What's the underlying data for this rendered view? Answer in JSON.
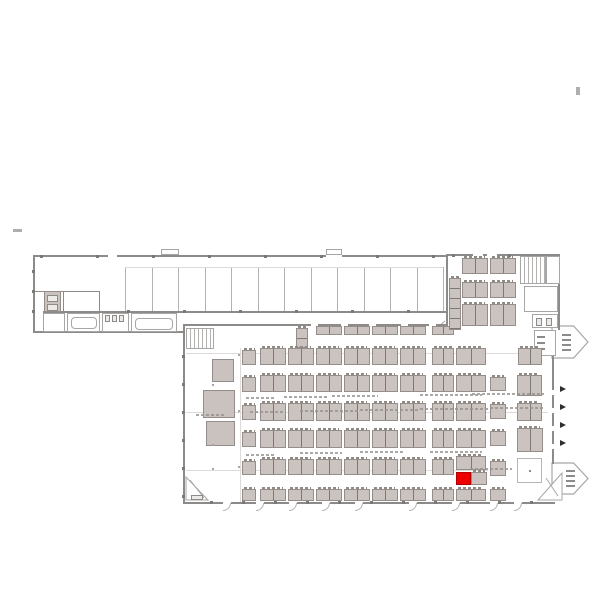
{
  "canvas": {
    "width": 600,
    "height": 600,
    "background": "#ffffff"
  },
  "colors": {
    "wall": "#8d8b89",
    "wall_light": "#b4b2b0",
    "faint": "#dddbd9",
    "booth_fill": "#cac3bf",
    "booth_border": "#948d89",
    "divider": "#7e7874",
    "highlight_red": "#ee0000",
    "arrow_dark": "#2e2e2e",
    "outline": "#a8a6a4"
  },
  "selected_booth": {
    "x": 456,
    "y": 472,
    "w": 15,
    "h": 13,
    "color": "#ee0000"
  },
  "walls": [
    [
      33,
      255,
      415,
      2
    ],
    [
      33,
      255,
      2,
      78
    ],
    [
      33,
      331,
      152,
      2
    ],
    [
      43,
      311,
      405,
      2
    ],
    [
      183,
      324,
      265,
      2
    ],
    [
      183,
      324,
      2,
      180
    ],
    [
      183,
      502,
      372,
      2
    ],
    [
      446,
      254,
      114,
      2
    ],
    [
      446,
      254,
      2,
      72
    ],
    [
      558,
      254,
      2,
      76
    ],
    [
      552,
      356,
      2,
      108
    ],
    [
      99,
      291,
      1,
      41
    ],
    [
      33,
      291,
      67,
      1
    ],
    [
      63,
      292,
      1,
      40
    ]
  ],
  "wall_gaps": [
    [
      108,
      255,
      9,
      2
    ],
    [
      326,
      255,
      16,
      2
    ],
    [
      473,
      254,
      10,
      2
    ],
    [
      487,
      254,
      10,
      2
    ],
    [
      311,
      324,
      7,
      2
    ],
    [
      341,
      324,
      7,
      2
    ],
    [
      369,
      324,
      7,
      2
    ],
    [
      401,
      324,
      7,
      2
    ],
    [
      429,
      324,
      7,
      2
    ],
    [
      552,
      390,
      2,
      5
    ],
    [
      552,
      408,
      2,
      5
    ],
    [
      552,
      426,
      2,
      5
    ],
    [
      552,
      444,
      2,
      5
    ],
    [
      223,
      502,
      8,
      2
    ],
    [
      256,
      502,
      8,
      2
    ],
    [
      289,
      502,
      8,
      2
    ],
    [
      322,
      502,
      8,
      2
    ],
    [
      355,
      502,
      8,
      2
    ],
    [
      409,
      502,
      8,
      2
    ],
    [
      452,
      502,
      8,
      2
    ],
    [
      490,
      502,
      8,
      2
    ],
    [
      514,
      502,
      8,
      2
    ]
  ],
  "partitions": {
    "x0": 125,
    "step": 26.5,
    "count": 13,
    "y": 267,
    "h": 44
  },
  "faint_lines": [
    [
      125,
      267,
      318,
      1
    ],
    [
      186,
      353,
      362,
      1
    ],
    [
      186,
      412,
      362,
      1
    ],
    [
      186,
      470,
      302,
      1
    ],
    [
      240,
      348,
      1,
      154
    ],
    [
      43,
      322,
      22,
      1
    ]
  ],
  "rooms": [
    [
      43,
      313,
      22,
      19
    ],
    [
      67,
      313,
      33,
      19
    ],
    [
      102,
      313,
      27,
      19
    ],
    [
      131,
      313,
      46,
      19
    ],
    [
      546,
      256,
      14,
      28
    ],
    [
      524,
      286,
      34,
      26
    ],
    [
      532,
      314,
      26,
      14
    ],
    [
      534,
      330,
      22,
      26
    ],
    [
      161,
      249,
      18,
      6
    ],
    [
      326,
      249,
      16,
      6
    ]
  ],
  "tables": [
    [
      71,
      317,
      26,
      12
    ],
    [
      135,
      318,
      38,
      12
    ]
  ],
  "elevator": {
    "x": 44,
    "y": 291,
    "w": 17,
    "h": 21
  },
  "fixtures": [
    [
      47,
      295,
      11,
      7
    ],
    [
      47,
      304,
      11,
      7
    ],
    [
      105,
      315,
      5,
      7
    ],
    [
      112,
      315,
      5,
      7
    ],
    [
      119,
      315,
      5,
      7
    ],
    [
      537,
      336,
      8,
      2
    ],
    [
      537,
      342,
      8,
      2
    ],
    [
      537,
      348,
      8,
      2
    ],
    [
      562,
      334,
      9,
      2
    ],
    [
      562,
      339,
      9,
      2
    ],
    [
      562,
      344,
      9,
      2
    ],
    [
      562,
      349,
      9,
      2
    ],
    [
      566,
      470,
      9,
      2
    ],
    [
      566,
      475,
      9,
      2
    ],
    [
      566,
      480,
      9,
      2
    ],
    [
      566,
      485,
      9,
      2
    ],
    [
      536,
      318,
      6,
      8
    ],
    [
      546,
      318,
      6,
      8
    ],
    [
      191,
      495,
      12,
      5
    ]
  ],
  "blocks": [
    [
      212,
      359,
      22,
      23
    ],
    [
      203,
      390,
      32,
      28
    ],
    [
      206,
      421,
      29,
      25
    ]
  ],
  "stair_rects": [
    [
      186,
      328,
      28,
      21
    ],
    [
      520,
      256,
      26,
      28
    ]
  ],
  "white_square": {
    "x": 517,
    "y": 458,
    "w": 25,
    "h": 25
  },
  "clusters": [
    [
      316,
      326,
      26,
      9,
      "h"
    ],
    [
      344,
      326,
      26,
      9,
      "h"
    ],
    [
      372,
      326,
      26,
      9,
      "h"
    ],
    [
      400,
      326,
      26,
      9,
      "h"
    ],
    [
      432,
      326,
      22,
      9,
      "h"
    ],
    [
      296,
      328,
      12,
      20,
      "v"
    ],
    [
      242,
      350,
      14,
      15,
      "s"
    ],
    [
      260,
      348,
      26,
      17,
      "h"
    ],
    [
      288,
      348,
      26,
      17,
      "h"
    ],
    [
      316,
      348,
      26,
      17,
      "h"
    ],
    [
      344,
      348,
      26,
      17,
      "h"
    ],
    [
      372,
      348,
      26,
      17,
      "h"
    ],
    [
      400,
      348,
      26,
      17,
      "h"
    ],
    [
      432,
      348,
      22,
      17,
      "h"
    ],
    [
      456,
      348,
      30,
      17,
      "h"
    ],
    [
      518,
      348,
      24,
      17,
      "h"
    ],
    [
      242,
      377,
      14,
      15,
      "s"
    ],
    [
      260,
      375,
      26,
      17,
      "h"
    ],
    [
      288,
      375,
      26,
      17,
      "h"
    ],
    [
      316,
      375,
      26,
      17,
      "h"
    ],
    [
      344,
      375,
      26,
      17,
      "h"
    ],
    [
      372,
      375,
      26,
      17,
      "h"
    ],
    [
      400,
      375,
      26,
      17,
      "h"
    ],
    [
      432,
      375,
      22,
      17,
      "h"
    ],
    [
      456,
      375,
      30,
      17,
      "h"
    ],
    [
      490,
      377,
      16,
      14,
      "s"
    ],
    [
      517,
      375,
      25,
      21,
      "h"
    ],
    [
      242,
      405,
      14,
      15,
      "s"
    ],
    [
      260,
      403,
      26,
      18,
      "h"
    ],
    [
      288,
      403,
      26,
      18,
      "h"
    ],
    [
      316,
      403,
      26,
      18,
      "h"
    ],
    [
      344,
      403,
      26,
      18,
      "h"
    ],
    [
      372,
      403,
      26,
      18,
      "h"
    ],
    [
      400,
      403,
      26,
      18,
      "h"
    ],
    [
      432,
      403,
      22,
      18,
      "h"
    ],
    [
      456,
      403,
      30,
      18,
      "h"
    ],
    [
      490,
      404,
      16,
      15,
      "s"
    ],
    [
      517,
      403,
      25,
      18,
      "h"
    ],
    [
      242,
      432,
      14,
      15,
      "s"
    ],
    [
      260,
      430,
      26,
      18,
      "h"
    ],
    [
      288,
      430,
      26,
      18,
      "h"
    ],
    [
      316,
      430,
      26,
      18,
      "h"
    ],
    [
      344,
      430,
      26,
      18,
      "h"
    ],
    [
      372,
      430,
      26,
      18,
      "h"
    ],
    [
      400,
      430,
      26,
      18,
      "h"
    ],
    [
      432,
      430,
      22,
      18,
      "h"
    ],
    [
      456,
      430,
      30,
      18,
      "h"
    ],
    [
      490,
      431,
      16,
      15,
      "s"
    ],
    [
      517,
      428,
      26,
      24,
      "h"
    ],
    [
      242,
      461,
      14,
      14,
      "s"
    ],
    [
      260,
      459,
      26,
      16,
      "h"
    ],
    [
      288,
      459,
      26,
      16,
      "h"
    ],
    [
      316,
      459,
      26,
      16,
      "h"
    ],
    [
      344,
      459,
      26,
      16,
      "h"
    ],
    [
      372,
      459,
      26,
      16,
      "h"
    ],
    [
      400,
      459,
      26,
      16,
      "h"
    ],
    [
      432,
      459,
      22,
      16,
      "h"
    ],
    [
      456,
      456,
      30,
      14,
      "h"
    ],
    [
      490,
      461,
      16,
      15,
      "s"
    ],
    [
      471,
      472,
      16,
      13,
      "s"
    ],
    [
      242,
      489,
      14,
      12,
      "s"
    ],
    [
      260,
      489,
      26,
      12,
      "h"
    ],
    [
      288,
      489,
      26,
      12,
      "h"
    ],
    [
      316,
      489,
      26,
      12,
      "h"
    ],
    [
      344,
      489,
      26,
      12,
      "h"
    ],
    [
      372,
      489,
      26,
      12,
      "h"
    ],
    [
      400,
      489,
      26,
      12,
      "h"
    ],
    [
      432,
      489,
      22,
      12,
      "h"
    ],
    [
      456,
      489,
      30,
      12,
      "h"
    ],
    [
      490,
      489,
      16,
      12,
      "s"
    ],
    [
      462,
      258,
      26,
      16,
      "h"
    ],
    [
      490,
      258,
      26,
      16,
      "h"
    ],
    [
      462,
      282,
      26,
      16,
      "h"
    ],
    [
      490,
      282,
      26,
      16,
      "h"
    ],
    [
      462,
      304,
      26,
      22,
      "h"
    ],
    [
      490,
      304,
      26,
      22,
      "h"
    ],
    [
      449,
      278,
      12,
      52,
      "v"
    ]
  ],
  "exit_pentagons": [
    {
      "x": 552,
      "y": 326,
      "w": 36,
      "h": 32
    },
    {
      "x": 552,
      "y": 463,
      "w": 36,
      "h": 31
    }
  ],
  "triangles": [
    {
      "points": "186,477 186,500 208,500"
    },
    {
      "points": "562,473 562,500 538,500"
    }
  ],
  "diagonals": [
    [
      158,
      331,
      172,
      319
    ],
    [
      433,
      331,
      445,
      321
    ],
    [
      190,
      480,
      204,
      498
    ],
    [
      546,
      478,
      558,
      496
    ]
  ],
  "door_arrows": [
    [
      560,
      386
    ],
    [
      560,
      404
    ],
    [
      560,
      422
    ],
    [
      560,
      440
    ]
  ],
  "door_arcs": [
    223,
    256,
    289,
    322,
    355,
    409,
    452,
    490,
    514
  ],
  "ticks": [
    [
      40,
      255
    ],
    [
      96,
      255
    ],
    [
      152,
      255
    ],
    [
      208,
      255
    ],
    [
      264,
      255
    ],
    [
      320,
      255
    ],
    [
      376,
      255
    ],
    [
      432,
      255
    ],
    [
      127,
      310
    ],
    [
      183,
      310
    ],
    [
      239,
      310
    ],
    [
      295,
      310
    ],
    [
      351,
      310
    ],
    [
      407,
      310
    ],
    [
      32,
      270
    ],
    [
      32,
      290
    ],
    [
      32,
      310
    ],
    [
      182,
      355
    ],
    [
      182,
      383
    ],
    [
      182,
      411
    ],
    [
      182,
      439
    ],
    [
      182,
      467
    ],
    [
      182,
      495
    ],
    [
      210,
      501
    ],
    [
      242,
      501
    ],
    [
      274,
      501
    ],
    [
      306,
      501
    ],
    [
      338,
      501
    ],
    [
      370,
      501
    ],
    [
      402,
      501
    ],
    [
      434,
      501
    ],
    [
      466,
      501
    ],
    [
      498,
      501
    ],
    [
      530,
      501
    ],
    [
      452,
      254
    ],
    [
      508,
      254
    ]
  ],
  "dots": [
    [
      212,
      384
    ],
    [
      212,
      414
    ],
    [
      212,
      444
    ],
    [
      212,
      468
    ],
    [
      238,
      354
    ],
    [
      238,
      410
    ],
    [
      238,
      466
    ]
  ],
  "smudges": [
    [
      246,
      397,
      30
    ],
    [
      284,
      396,
      44
    ],
    [
      332,
      395,
      46
    ],
    [
      420,
      394,
      62
    ],
    [
      472,
      393,
      72
    ],
    [
      246,
      454,
      28
    ],
    [
      300,
      452,
      42
    ],
    [
      360,
      451,
      44
    ],
    [
      430,
      451,
      52
    ],
    [
      470,
      468,
      42
    ],
    [
      196,
      414,
      30
    ],
    [
      250,
      411,
      34
    ],
    [
      300,
      410,
      60
    ],
    [
      360,
      409,
      60
    ],
    [
      420,
      408,
      70
    ],
    [
      490,
      407,
      55
    ]
  ],
  "tiny_marks": [
    {
      "x": 13,
      "y": 229,
      "w": 9,
      "h": 3
    },
    {
      "x": 576,
      "y": 87,
      "w": 4,
      "h": 8
    }
  ]
}
